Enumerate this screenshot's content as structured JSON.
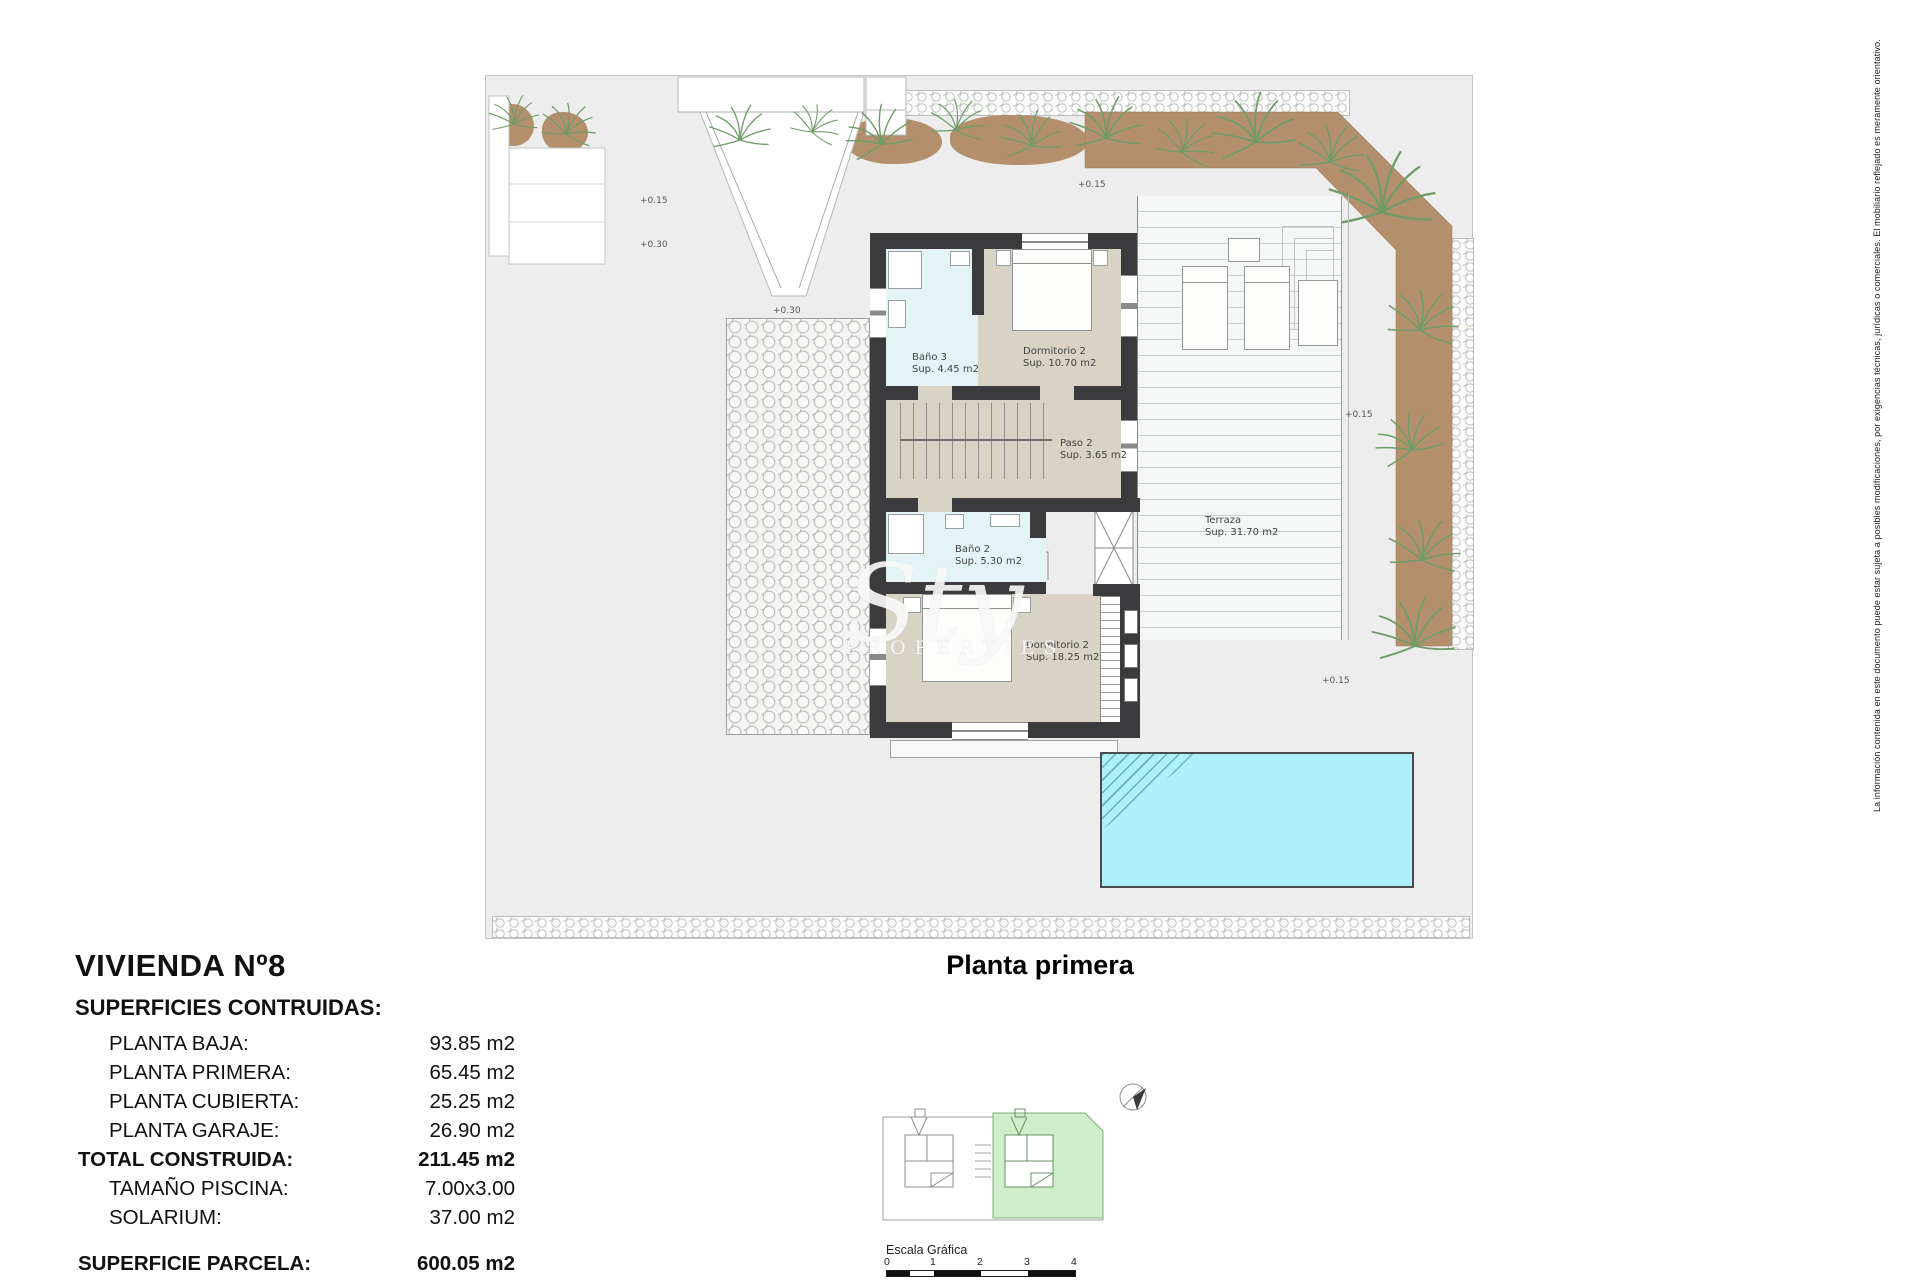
{
  "project": {
    "title": "VIVIENDA Nº8",
    "plan_title": "Planta primera"
  },
  "surfaces": {
    "heading": "SUPERFICIES CONTRUIDAS:",
    "rows": [
      {
        "label": "PLANTA BAJA:",
        "value": "93.85 m2"
      },
      {
        "label": "PLANTA PRIMERA:",
        "value": "65.45 m2"
      },
      {
        "label": "PLANTA CUBIERTA:",
        "value": "25.25 m2"
      },
      {
        "label": "PLANTA GARAJE:",
        "value": "26.90 m2"
      },
      {
        "label": "TOTAL CONSTRUIDA:",
        "value": "211.45 m2"
      },
      {
        "label": "TAMAÑO PISCINA:",
        "value": "7.00x3.00"
      },
      {
        "label": "SOLARIUM:",
        "value": "37.00 m2"
      },
      {
        "label": "SUPERFICIE PARCELA:",
        "value": "600.05 m2"
      }
    ]
  },
  "plan": {
    "rooms": [
      {
        "name": "Baño 3",
        "area": "Sup. 4.45 m2"
      },
      {
        "name": "Dormitorio 2",
        "area": "Sup. 10.70 m2"
      },
      {
        "name": "Paso 2",
        "area": "Sup. 3.65 m2"
      },
      {
        "name": "Baño 2",
        "area": "Sup. 5.30 m2"
      },
      {
        "name": "Dormitorio 2",
        "area": "Sup. 18.25 m2"
      },
      {
        "name": "Terraza",
        "area": "Sup. 31.70 m2"
      }
    ],
    "levels": [
      {
        "text": "+0.15"
      },
      {
        "text": "+0.15"
      },
      {
        "text": "+0.30"
      },
      {
        "text": "+0.30"
      },
      {
        "text": "+0.15"
      },
      {
        "text": "+0.15"
      }
    ]
  },
  "watermark": {
    "script": "Sty",
    "caption": "PROPERTIES"
  },
  "scalebar": {
    "label": "Escala Gráfica",
    "ticks": [
      "0",
      "1",
      "2",
      "3",
      "4"
    ]
  },
  "disclaimer": "La información contenida en este documento puede estar sujeta a posibles modificaciones, por exigencias técnicas, jurídicas o comerciales. El mobiliario reflejado es meramente orientativo.",
  "colors": {
    "wall": "#3b3b3d",
    "bedroom_floor": "#d9d3c5",
    "bath_floor": "#e4f4f6",
    "pool": "#aef0fa",
    "planter": "#b3906b",
    "keyplan_highlight": "#cdeec8"
  }
}
